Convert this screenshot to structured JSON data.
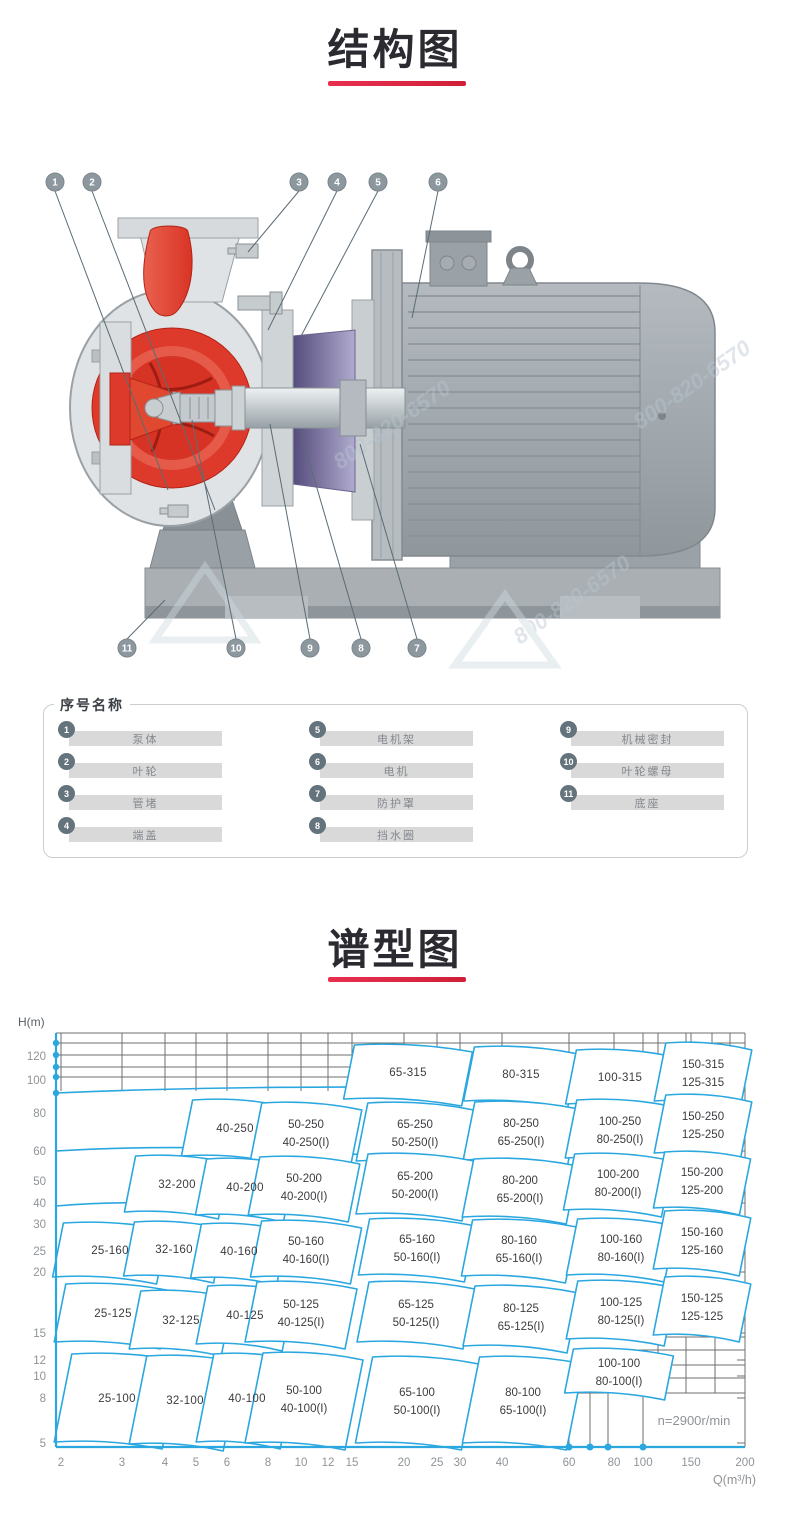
{
  "sections": {
    "structure": {
      "title": "结构图"
    },
    "spectrum": {
      "title": "谱型图"
    }
  },
  "diagram": {
    "callouts": [
      "1",
      "2",
      "3",
      "4",
      "5",
      "6",
      "7",
      "8",
      "9",
      "10",
      "11"
    ],
    "watermark_text": "800-820-6570"
  },
  "legend": {
    "title": "序号名称",
    "items": [
      {
        "num": "1",
        "label": "泵体"
      },
      {
        "num": "2",
        "label": "叶轮"
      },
      {
        "num": "3",
        "label": "管堵"
      },
      {
        "num": "4",
        "label": "端盖"
      },
      {
        "num": "5",
        "label": "电机架"
      },
      {
        "num": "6",
        "label": "电机"
      },
      {
        "num": "7",
        "label": "防护罩"
      },
      {
        "num": "8",
        "label": "挡水圈"
      },
      {
        "num": "9",
        "label": "机械密封"
      },
      {
        "num": "10",
        "label": "叶轮螺母"
      },
      {
        "num": "11",
        "label": "底座"
      }
    ]
  },
  "chart_data": {
    "type": "area",
    "description": "Pump model selection chart (log-log). Each curved cell is the operating region of one pump model, labeled flow size - impeller size.",
    "title": "谱型图",
    "xlabel": "Q(m³/h)",
    "ylabel": "H(m)",
    "x_scale": "log",
    "y_scale": "log",
    "x_range": [
      2,
      200
    ],
    "y_range": [
      5,
      140
    ],
    "grid": true,
    "annotation": "n=2900r/min",
    "colors": {
      "curve": "#2BA7E0",
      "grid": "#6f6f6f",
      "tick_text": "#8f9397",
      "label_text": "#3c3c40"
    },
    "x_ticks": [
      {
        "label": "2",
        "px": 61
      },
      {
        "label": "3",
        "px": 122
      },
      {
        "label": "4",
        "px": 165
      },
      {
        "label": "5",
        "px": 196
      },
      {
        "label": "6",
        "px": 227
      },
      {
        "label": "8",
        "px": 268
      },
      {
        "label": "10",
        "px": 301
      },
      {
        "label": "12",
        "px": 328
      },
      {
        "label": "15",
        "px": 352
      },
      {
        "label": "20",
        "px": 404
      },
      {
        "label": "25",
        "px": 437
      },
      {
        "label": "30",
        "px": 460
      },
      {
        "label": "40",
        "px": 502
      },
      {
        "label": "60",
        "px": 569
      },
      {
        "label": "80",
        "px": 614
      },
      {
        "label": "100",
        "px": 643
      },
      {
        "label": "150",
        "px": 691
      },
      {
        "label": "200",
        "px": 745
      }
    ],
    "y_ticks": [
      {
        "label": "120",
        "px": 1056
      },
      {
        "label": "100",
        "px": 1080
      },
      {
        "label": "80",
        "px": 1113
      },
      {
        "label": "60",
        "px": 1151
      },
      {
        "label": "50",
        "px": 1181
      },
      {
        "label": "40",
        "px": 1203
      },
      {
        "label": "30",
        "px": 1224
      },
      {
        "label": "25",
        "px": 1251
      },
      {
        "label": "20",
        "px": 1272
      },
      {
        "label": "15",
        "px": 1333
      },
      {
        "label": "12",
        "px": 1360
      },
      {
        "label": "10",
        "px": 1376
      },
      {
        "label": "8",
        "px": 1398
      },
      {
        "label": "5",
        "px": 1443
      }
    ],
    "regions": [
      {
        "labels": [
          "65-315"
        ],
        "x": 408,
        "y": 1072,
        "w": 118,
        "h": 54
      },
      {
        "labels": [
          "80-315"
        ],
        "x": 521,
        "y": 1074,
        "w": 104,
        "h": 54
      },
      {
        "labels": [
          "100-315"
        ],
        "x": 620,
        "y": 1077,
        "w": 98,
        "h": 54
      },
      {
        "labels": [
          "150-315",
          "125-315"
        ],
        "x": 703,
        "y": 1072,
        "w": 86,
        "h": 58
      },
      {
        "labels": [
          "40-250"
        ],
        "x": 235,
        "y": 1128,
        "w": 96,
        "h": 56
      },
      {
        "labels": [
          "50-250",
          "40-250(I)"
        ],
        "x": 306,
        "y": 1132,
        "w": 100,
        "h": 58
      },
      {
        "labels": [
          "65-250",
          "50-250(I)"
        ],
        "x": 415,
        "y": 1132,
        "w": 106,
        "h": 58
      },
      {
        "labels": [
          "80-250",
          "65-250(I)"
        ],
        "x": 521,
        "y": 1131,
        "w": 104,
        "h": 58
      },
      {
        "labels": [
          "100-250",
          "80-250(I)"
        ],
        "x": 620,
        "y": 1129,
        "w": 98,
        "h": 58
      },
      {
        "labels": [
          "150-250",
          "125-250"
        ],
        "x": 703,
        "y": 1124,
        "w": 86,
        "h": 58
      },
      {
        "labels": [
          "32-200"
        ],
        "x": 177,
        "y": 1184,
        "w": 94,
        "h": 56
      },
      {
        "labels": [
          "40-200"
        ],
        "x": 245,
        "y": 1187,
        "w": 88,
        "h": 56
      },
      {
        "labels": [
          "50-200",
          "40-200(I)"
        ],
        "x": 304,
        "y": 1186,
        "w": 100,
        "h": 58
      },
      {
        "labels": [
          "65-200",
          "50-200(I)"
        ],
        "x": 415,
        "y": 1184,
        "w": 106,
        "h": 60
      },
      {
        "labels": [
          "80-200",
          "65-200(I)"
        ],
        "x": 520,
        "y": 1188,
        "w": 104,
        "h": 58
      },
      {
        "labels": [
          "100-200",
          "80-200(I)"
        ],
        "x": 618,
        "y": 1182,
        "w": 98,
        "h": 56
      },
      {
        "labels": [
          "150-200",
          "125-200"
        ],
        "x": 702,
        "y": 1180,
        "w": 86,
        "h": 56
      },
      {
        "labels": [
          "25-160"
        ],
        "x": 110,
        "y": 1250,
        "w": 104,
        "h": 54
      },
      {
        "labels": [
          "32-160"
        ],
        "x": 174,
        "y": 1249,
        "w": 90,
        "h": 54
      },
      {
        "labels": [
          "40-160"
        ],
        "x": 239,
        "y": 1251,
        "w": 86,
        "h": 54
      },
      {
        "labels": [
          "50-160",
          "40-160(I)"
        ],
        "x": 306,
        "y": 1249,
        "w": 100,
        "h": 56
      },
      {
        "labels": [
          "65-160",
          "50-160(I)"
        ],
        "x": 417,
        "y": 1247,
        "w": 106,
        "h": 56
      },
      {
        "labels": [
          "80-160",
          "65-160(I)"
        ],
        "x": 519,
        "y": 1248,
        "w": 104,
        "h": 56
      },
      {
        "labels": [
          "100-160",
          "80-160(I)"
        ],
        "x": 621,
        "y": 1247,
        "w": 98,
        "h": 56
      },
      {
        "labels": [
          "150-160",
          "125-160"
        ],
        "x": 702,
        "y": 1240,
        "w": 86,
        "h": 58
      },
      {
        "labels": [
          "25-125"
        ],
        "x": 113,
        "y": 1313,
        "w": 106,
        "h": 58
      },
      {
        "labels": [
          "32-125"
        ],
        "x": 181,
        "y": 1320,
        "w": 92,
        "h": 58
      },
      {
        "labels": [
          "40-125"
        ],
        "x": 245,
        "y": 1315,
        "w": 86,
        "h": 58
      },
      {
        "labels": [
          "50-125",
          "40-125(I)"
        ],
        "x": 301,
        "y": 1312,
        "w": 100,
        "h": 60
      },
      {
        "labels": [
          "65-125",
          "50-125(I)"
        ],
        "x": 416,
        "y": 1312,
        "w": 106,
        "h": 60
      },
      {
        "labels": [
          "80-125",
          "65-125(I)"
        ],
        "x": 521,
        "y": 1316,
        "w": 104,
        "h": 60
      },
      {
        "labels": [
          "100-125",
          "80-125(I)"
        ],
        "x": 621,
        "y": 1310,
        "w": 98,
        "h": 58
      },
      {
        "labels": [
          "150-125",
          "125-125"
        ],
        "x": 702,
        "y": 1306,
        "w": 86,
        "h": 58
      },
      {
        "labels": [
          "25-100"
        ],
        "x": 117,
        "y": 1398,
        "w": 108,
        "h": 88
      },
      {
        "labels": [
          "32-100"
        ],
        "x": 185,
        "y": 1400,
        "w": 94,
        "h": 88
      },
      {
        "labels": [
          "40-100"
        ],
        "x": 247,
        "y": 1398,
        "w": 84,
        "h": 88
      },
      {
        "labels": [
          "50-100",
          "40-100(I)"
        ],
        "x": 304,
        "y": 1398,
        "w": 100,
        "h": 90
      },
      {
        "labels": [
          "65-100",
          "50-100(I)"
        ],
        "x": 417,
        "y": 1400,
        "w": 106,
        "h": 86
      },
      {
        "labels": [
          "80-100",
          "65-100(I)"
        ],
        "x": 523,
        "y": 1400,
        "w": 104,
        "h": 86
      },
      {
        "labels": [
          "100-100",
          "80-100(I)"
        ],
        "x": 619,
        "y": 1371,
        "w": 100,
        "h": 44
      }
    ]
  },
  "colors": {
    "accent_red": "#E02742",
    "title_text": "#2A2A30",
    "curve_blue": "#2BA7E0"
  }
}
